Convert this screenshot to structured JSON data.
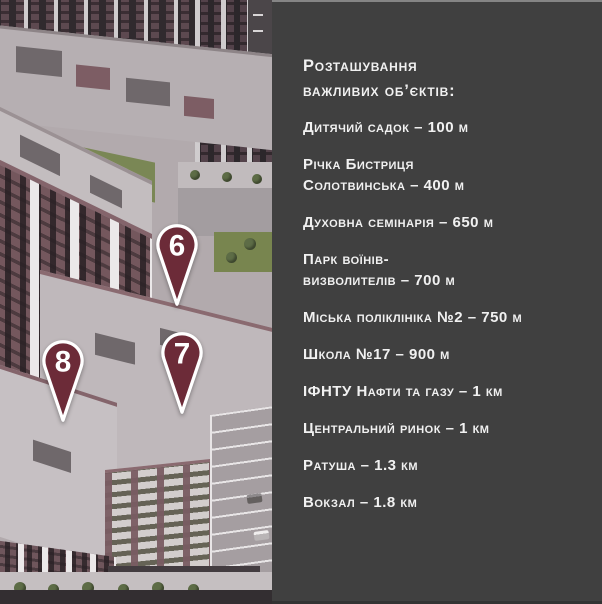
{
  "panel": {
    "title": "Розташування\nважливих об’єктів:",
    "items": [
      {
        "label": "Дитячий садок – 100 м"
      },
      {
        "label": "Річка Бистриця\nСолотвинська – 400 м"
      },
      {
        "label": "Духовна семінарія – 650 м"
      },
      {
        "label": "Парк воїнів-\nвизволителів – 700 м"
      },
      {
        "label": "Міська поліклініка №2 – 750 м"
      },
      {
        "label": "Школа №17 – 900 м"
      },
      {
        "label": "ІФНТУ Нафти та газу – 1 км"
      },
      {
        "label": "Центральний ринок – 1 км"
      },
      {
        "label": "Ратуша – 1.3 км"
      },
      {
        "label": "Вокзал – 1.8 км"
      }
    ]
  },
  "map": {
    "pins": [
      {
        "number": "6"
      },
      {
        "number": "7"
      },
      {
        "number": "8"
      }
    ]
  },
  "colors": {
    "panel_bg": "#404040",
    "panel_text": "#f1f1f1",
    "pin_fill": "#6c2b38",
    "pin_outline": "#ffffff"
  }
}
